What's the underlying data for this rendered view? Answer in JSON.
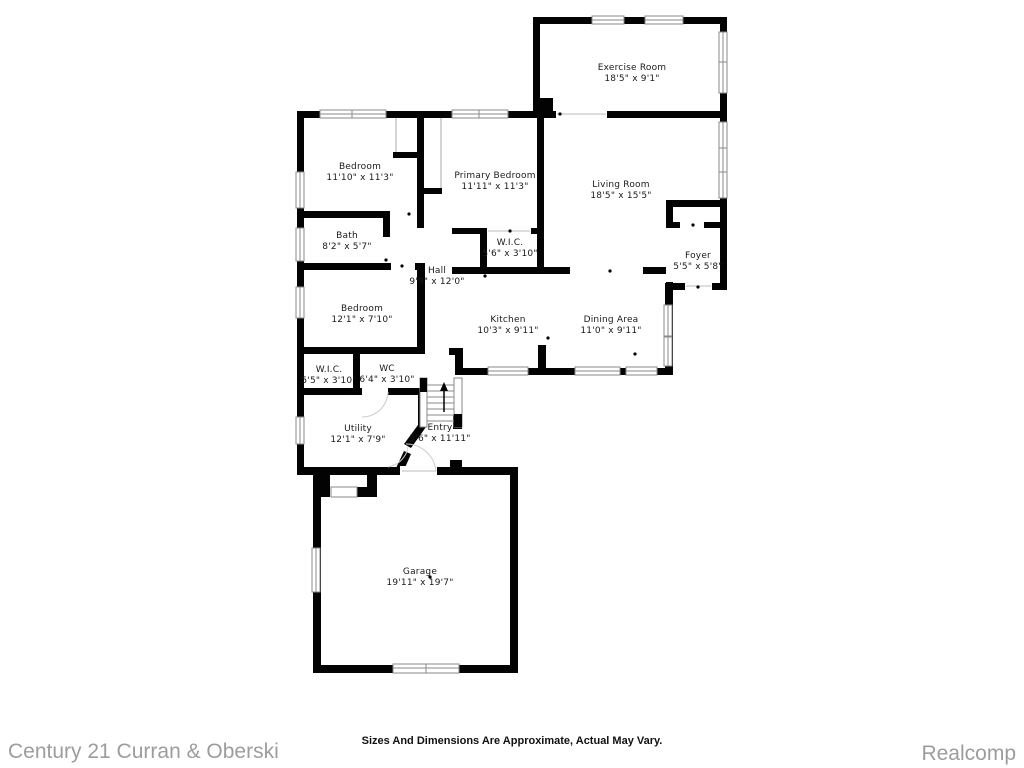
{
  "document_type": "residential floor plan",
  "colors": {
    "background": "#ffffff",
    "wall": "#030303",
    "room_text": "#1a1a1a",
    "window_stroke": "#8a8a8a",
    "footer_gray": "#9d9d9d"
  },
  "rooms": [
    {
      "label": "Exercise Room",
      "dims": "18'5\" x 9'1\""
    },
    {
      "label": "Bedroom",
      "dims": "11'10\" x 11'3\""
    },
    {
      "label": "Primary Bedroom",
      "dims": "11'11\" x 11'3\""
    },
    {
      "label": "Living Room",
      "dims": "18'5\" x 15'5\""
    },
    {
      "label": "Bath",
      "dims": "8'2\" x 5'7\""
    },
    {
      "label": "W.I.C.",
      "dims": "5'6\" x 3'10\""
    },
    {
      "label": "Foyer",
      "dims": "5'5\" x 5'8\""
    },
    {
      "label": "Hall",
      "dims": "9'9\" x 12'0\""
    },
    {
      "label": "Bedroom",
      "dims": "12'1\" x 7'10\""
    },
    {
      "label": "Kitchen",
      "dims": "10'3\" x 9'11\""
    },
    {
      "label": "Dining Area",
      "dims": "11'0\" x 9'11\""
    },
    {
      "label": "W.I.C.",
      "dims": "5'5\" x 3'10\""
    },
    {
      "label": "WC",
      "dims": "6'4\" x 3'10\""
    },
    {
      "label": "Utility",
      "dims": "12'1\" x 7'9\""
    },
    {
      "label": "Entry",
      "dims": "5'6\" x 11'11\""
    },
    {
      "label": "Garage",
      "dims": "19'11\" x 19'7\""
    }
  ],
  "footer": {
    "disclaimer": "Sizes And Dimensions Are Approximate, Actual May Vary.",
    "left_brand": "Century 21 Curran & Oberski",
    "right_brand": "Realcomp"
  }
}
